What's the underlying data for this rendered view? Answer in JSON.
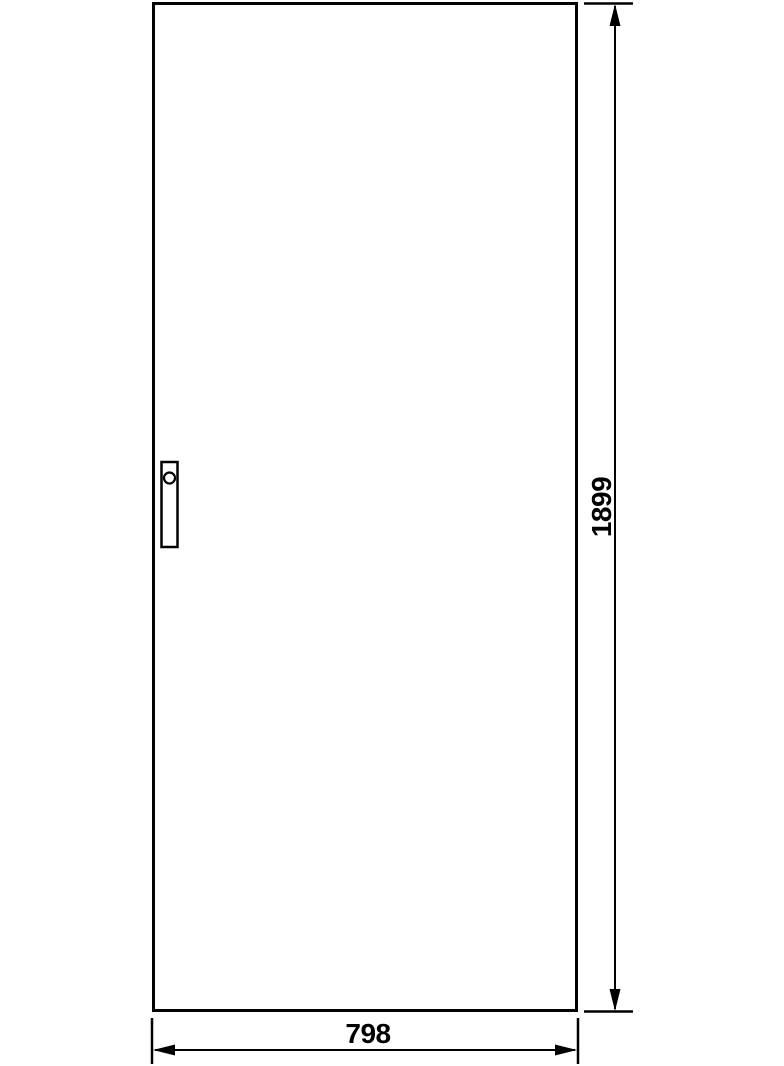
{
  "drawing": {
    "type": "technical-drawing",
    "subject": "door-panel-front-view",
    "colors": {
      "line": "#000000",
      "background": "#ffffff"
    },
    "dimensions": {
      "height_label": "1899",
      "width_label": "798"
    }
  }
}
